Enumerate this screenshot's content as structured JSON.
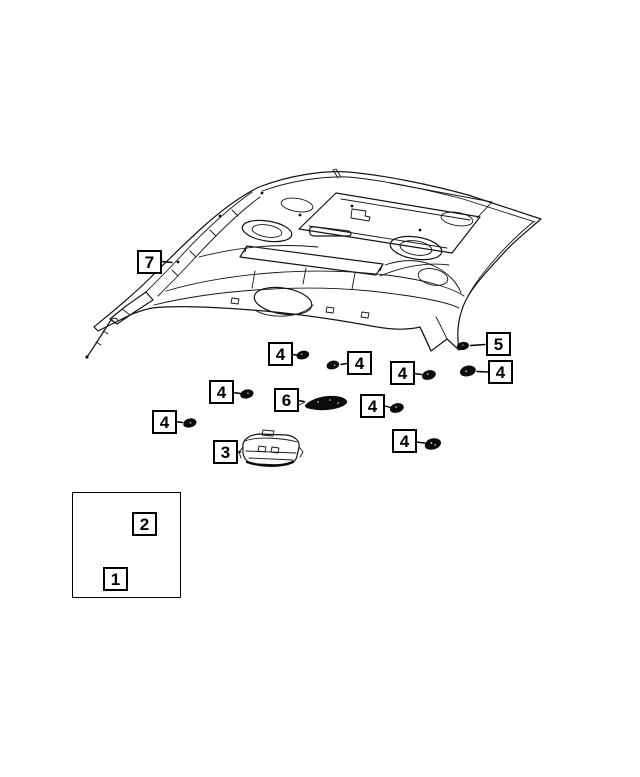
{
  "figure": {
    "kind": "parts-diagram",
    "subject": "Vehicle headliner and overhead lamp parts diagram",
    "background_color": "#ffffff",
    "line_color": "#000000"
  },
  "callouts": {
    "item1": "1",
    "item2": "2",
    "item3": "3",
    "item4": "4",
    "item5": "5",
    "item6": "6",
    "item7": "7"
  }
}
